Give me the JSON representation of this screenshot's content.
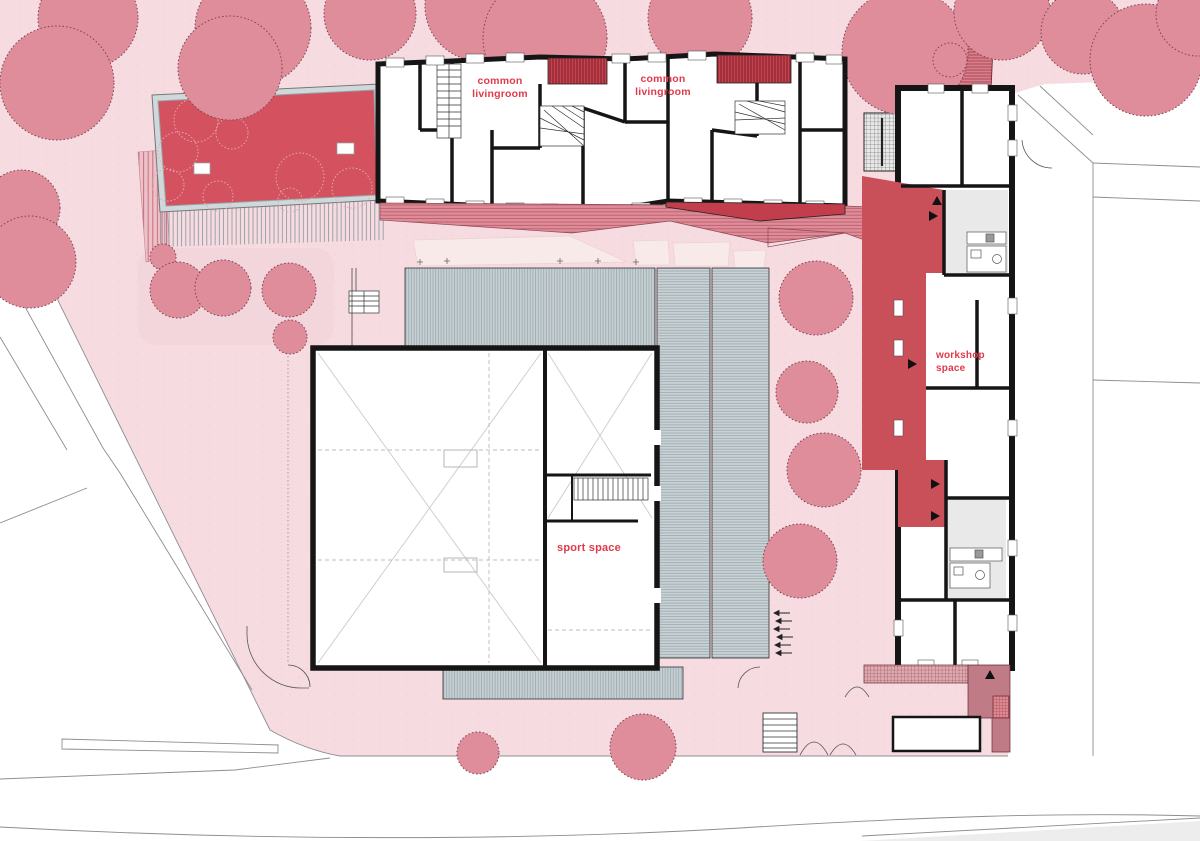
{
  "plan": {
    "type": "architectural-site-plan",
    "labels": {
      "cl1": {
        "l1": "common",
        "l2": "livingroom"
      },
      "cl2": {
        "l1": "common",
        "l2": "livingroom"
      },
      "workshop": {
        "l1": "workshop",
        "l2": "space"
      },
      "sport": {
        "l1": "sport space"
      }
    }
  },
  "colors": {
    "bg": "#f6dce1",
    "path_light": "#f8eae8",
    "bed_light": "#f3d6db",
    "tree_fill": "#e08d9b",
    "tree_stroke": "#7e4450",
    "outline": "#8d8d8d",
    "black": "#151515",
    "red_pool": "#d4525f",
    "red_corridor": "#c94f59",
    "red_dark_wedge": "#c23e4d",
    "deck_gray": "#cfd8da",
    "room_gray": "#e9e9e9",
    "mauve": "#bf7c87",
    "label_red": "#e0394b",
    "road_gray": "#ededed"
  }
}
